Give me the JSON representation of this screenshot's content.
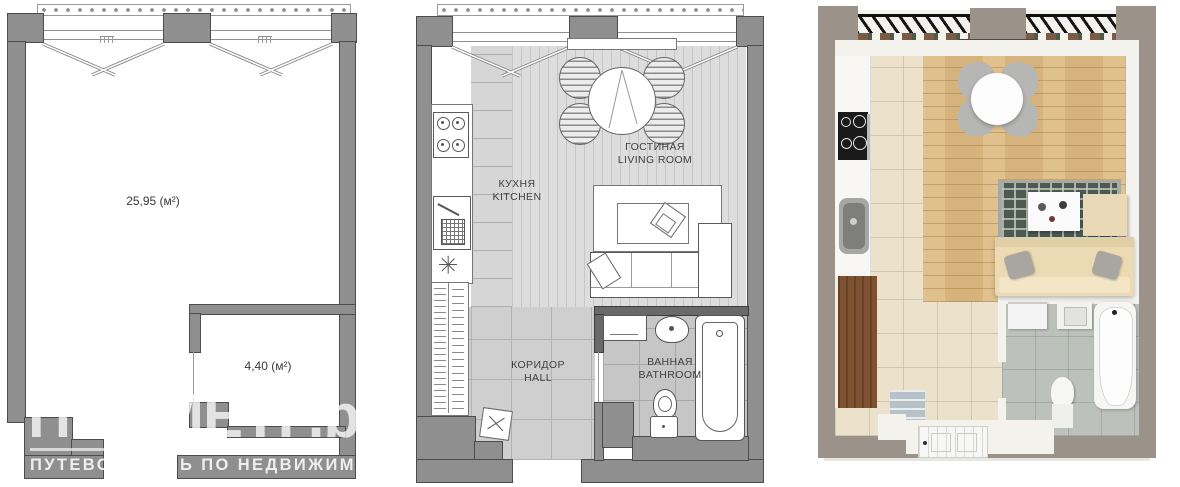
{
  "watermark": {
    "brand": "ПРОМЕТР.by",
    "tagline": "ПУТЕВОДИТЕЛЬ ПО НЕДВИЖИМОСТИ"
  },
  "plans": {
    "schematic": {
      "areas": {
        "main": "25,95 (м²)",
        "small": "4,40 (м²)"
      }
    },
    "furnished": {
      "rooms": {
        "kitchen": {
          "ru": "КУХНЯ",
          "en": "KITCHEN"
        },
        "living": {
          "ru": "ГОСТИНАЯ",
          "en": "LIVING ROOM"
        },
        "hall": {
          "ru": "КОРИДОР",
          "en": "HALL"
        },
        "bathroom": {
          "ru": "ВАННАЯ",
          "en": "BATHROOM"
        }
      }
    }
  },
  "colors": {
    "wall2d": "#8f8f8f",
    "wallDark": "#696969",
    "plank": "#dddddd",
    "plankLine": "#c6c6c6",
    "tileKitchen": "#d6d6d6",
    "tileHall": "#cfcfcf",
    "tileBath": "#c6c6c6",
    "wall3d": "#9b9289",
    "beige": "#ece1cb",
    "wood": "#d6b37c",
    "marble": "#bcc2bb",
    "cream": "#ecdab4",
    "rugDark": "#4c5a50",
    "wardrobe": "#7c5231",
    "watermark": "rgba(255,255,255,0.75)"
  }
}
